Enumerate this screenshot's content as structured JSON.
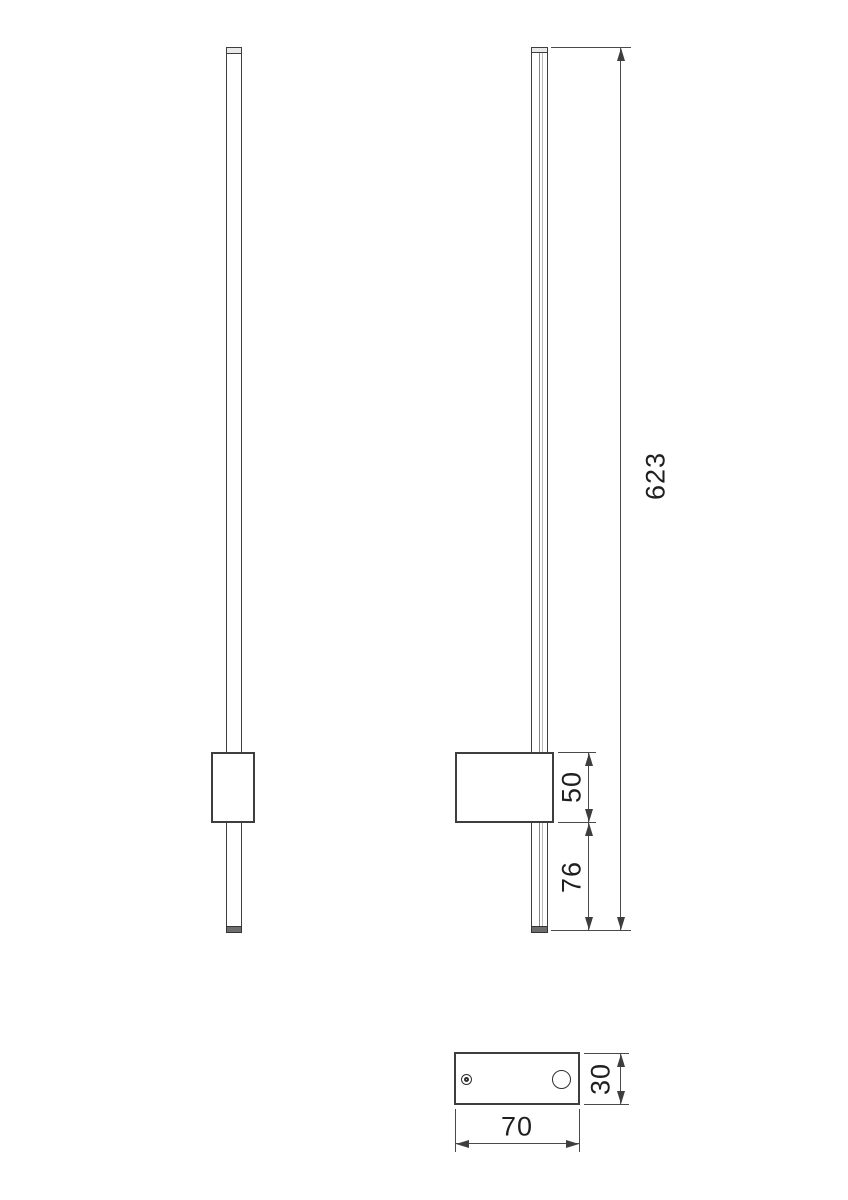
{
  "drawing": {
    "labels": {
      "total_height": "623",
      "driver_box_height": "50",
      "bottom_overhang": "76",
      "base_width": "70",
      "base_depth": "30"
    },
    "colors": {
      "background": "#ffffff",
      "object_line": "#3e3e3e",
      "dimension_line": "#4a4a4a",
      "text": "#1f1f1f"
    }
  }
}
